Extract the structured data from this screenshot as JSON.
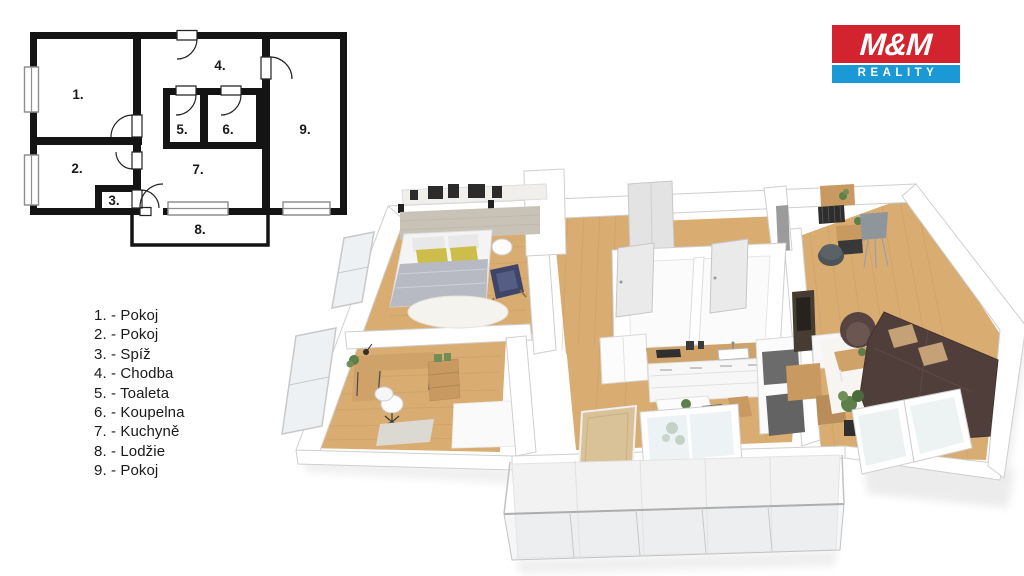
{
  "logo": {
    "line1": "M&M",
    "line2": "REALITY",
    "colors": {
      "red": "#d2232e",
      "blue": "#1a99d6",
      "text": "#ffffff"
    }
  },
  "legend": {
    "text_color": "#1a1a1a",
    "items": [
      "1. - Pokoj",
      "2. - Pokoj",
      "3. - Spíž",
      "4. - Chodba",
      "5. - Toaleta",
      "6. - Koupelna",
      "7. - Kuchyně",
      "8. - Lodžie",
      "9. - Pokoj"
    ]
  },
  "plan2d": {
    "wall_color": "#141414",
    "window_color": "#8f8f8f",
    "room_numbers": [
      "1.",
      "2.",
      "3.",
      "4.",
      "5.",
      "6.",
      "7.",
      "8.",
      "9."
    ]
  },
  "plan3d": {
    "colors": {
      "floor_wood": "#d9ad72",
      "floor_wood_line": "#c2905a",
      "wall": "#ffffff",
      "wall_edge": "#cfcfcf",
      "bathroom_floor": "#fbfbfb",
      "sofa": "#4f3e3a",
      "sofa_pillow": "#c4a177",
      "armchair_navy": "#3f4569",
      "armchair_brown": "#574441",
      "bed_blanket": "#b7bac3",
      "pillow_yellow": "#cdbd4a",
      "wood_furniture": "#cfa26a",
      "appliance_dark": "#6b6b6b",
      "plant_green": "#5d7f4a",
      "lamp_gray": "#8f969b",
      "glass": "#e7edf0",
      "shadow": "#ececec"
    }
  }
}
